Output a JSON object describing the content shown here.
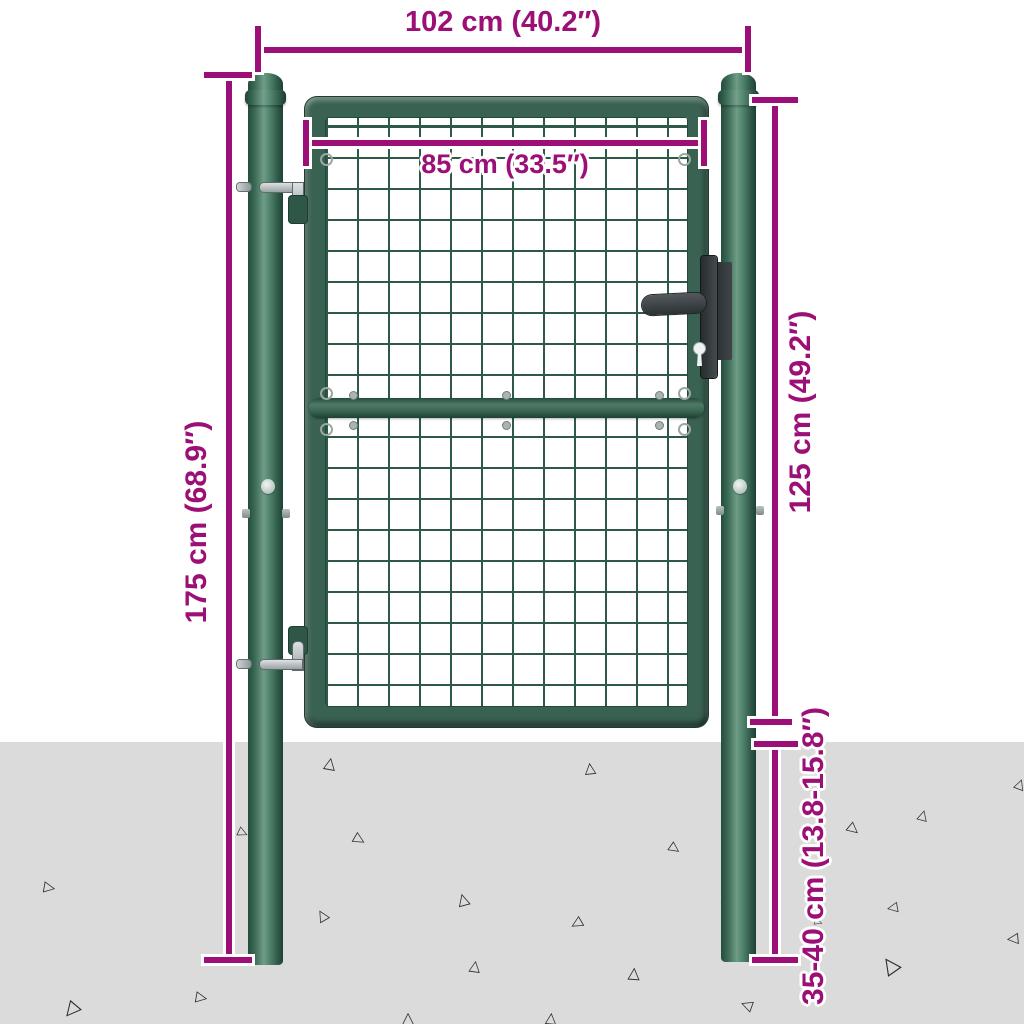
{
  "figure": {
    "type": "product-dimension-diagram",
    "subject": "green mesh garden gate with two round posts set into the ground"
  },
  "labels": {
    "total_width": "102 cm (40.2″)",
    "gate_width": "85 cm (33.5″)",
    "post_height": "175 cm (68.9″)",
    "gate_height": "125 cm (49.2″)",
    "ground_depth": "35-40 cm (13.8-15.8″)"
  },
  "colors": {
    "dimension_accent": "#9b0f76",
    "gate_green": "#3a6252",
    "mesh_green": "#2e5949",
    "ground_gray": "#dbdbdb",
    "hardware_dark": "#363c3e",
    "metal_gray": "#b9c0c2"
  },
  "ground": {
    "triangle_glyph": "△",
    "triangles": [
      {
        "x": 330,
        "y": 763,
        "size": 16,
        "rot": 10
      },
      {
        "x": 590,
        "y": 768,
        "size": 15,
        "rot": -6
      },
      {
        "x": 50,
        "y": 888,
        "size": 15,
        "rot": 100
      },
      {
        "x": 243,
        "y": 833,
        "size": 13,
        "rot": 115
      },
      {
        "x": 360,
        "y": 840,
        "size": 15,
        "rot": 120
      },
      {
        "x": 322,
        "y": 915,
        "size": 15,
        "rot": -30
      },
      {
        "x": 463,
        "y": 899,
        "size": 16,
        "rot": -15
      },
      {
        "x": 475,
        "y": 966,
        "size": 15,
        "rot": 8
      },
      {
        "x": 576,
        "y": 924,
        "size": 15,
        "rot": -120
      },
      {
        "x": 634,
        "y": 973,
        "size": 16,
        "rot": 4
      },
      {
        "x": 675,
        "y": 849,
        "size": 14,
        "rot": 125
      },
      {
        "x": 727,
        "y": 900,
        "size": 12,
        "rot": 100
      },
      {
        "x": 818,
        "y": 922,
        "size": 10,
        "rot": 110
      },
      {
        "x": 854,
        "y": 830,
        "size": 15,
        "rot": 130
      },
      {
        "x": 923,
        "y": 815,
        "size": 14,
        "rot": 15
      },
      {
        "x": 892,
        "y": 908,
        "size": 14,
        "rot": -100
      },
      {
        "x": 890,
        "y": 965,
        "size": 22,
        "rot": -35
      },
      {
        "x": 1012,
        "y": 939,
        "size": 15,
        "rot": -95
      },
      {
        "x": 1020,
        "y": 784,
        "size": 14,
        "rot": 20
      },
      {
        "x": 202,
        "y": 998,
        "size": 15,
        "rot": 100
      },
      {
        "x": 70,
        "y": 1012,
        "size": 20,
        "rot": -140
      },
      {
        "x": 408,
        "y": 1018,
        "size": 16,
        "rot": 0
      },
      {
        "x": 551,
        "y": 1018,
        "size": 15,
        "rot": 5
      },
      {
        "x": 746,
        "y": 1005,
        "size": 15,
        "rot": -70
      }
    ]
  }
}
